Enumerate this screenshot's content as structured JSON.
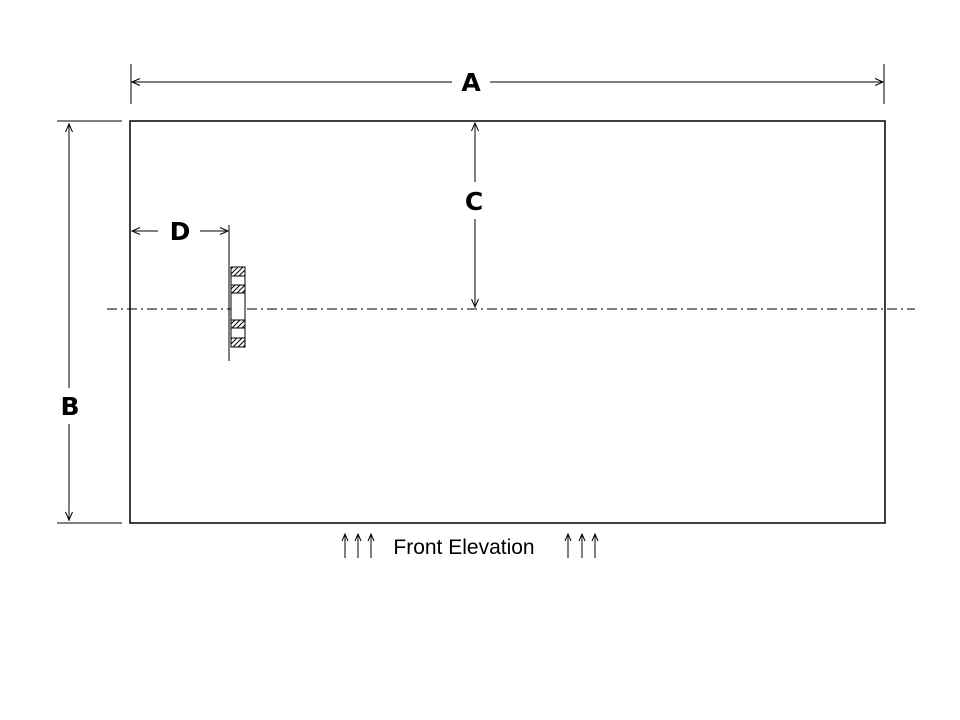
{
  "page": {
    "background_color": "#ffffff",
    "line_color": "#000000",
    "text_color": "#000000"
  },
  "drawing": {
    "title": "Front Elevation",
    "view": "technical elevation drawing of a rectangular panel",
    "dimensions": {
      "a": {
        "label": "A",
        "orientation": "horizontal",
        "measures": "overall width (top)"
      },
      "b": {
        "label": "B",
        "orientation": "vertical",
        "measures": "overall height (left)"
      },
      "c": {
        "label": "C",
        "orientation": "vertical",
        "measures": "top edge to centerline"
      },
      "d": {
        "label": "D",
        "orientation": "horizontal",
        "measures": "left edge to stud detail"
      }
    },
    "details": {
      "centerline_style": "dash-dot",
      "stud_detail": "small hatched cross-section column on centerline",
      "flow_arrows": {
        "icon": "up-arrow-icon",
        "left_count": 3,
        "right_count": 3
      }
    }
  }
}
